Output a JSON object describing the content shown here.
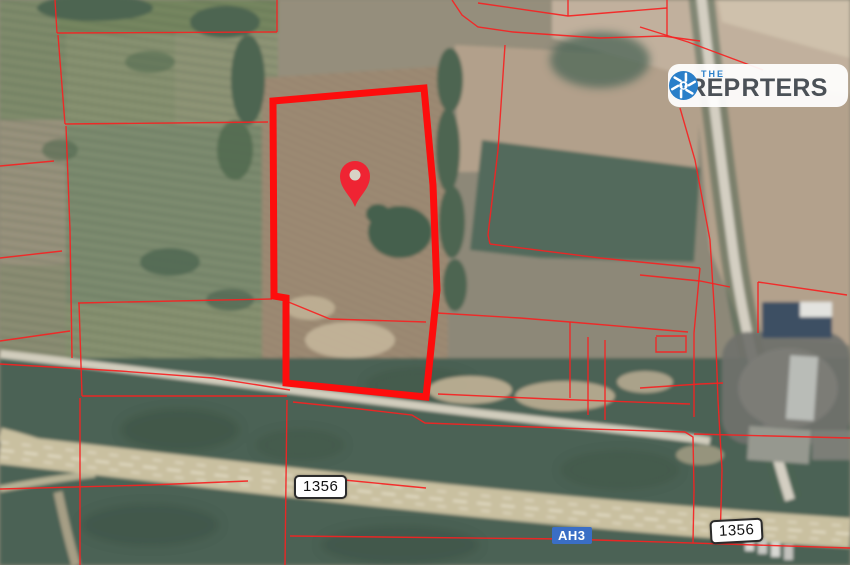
{
  "watermark": {
    "prefix": "THE",
    "brand_left": "REP",
    "brand_right": "RTERS",
    "accent_blue": "#2a7fc9",
    "text_color": "#4b5157"
  },
  "road_labels": {
    "route_left": "1356",
    "route_right": "1356",
    "highway": "AH3",
    "highway_bg": "#3a6ec5"
  },
  "overlay": {
    "line_color": "#f62222",
    "parcel_color": "#fd0d0d",
    "pin_color": "#ef2433",
    "pin_hole_color": "#d8d2c6",
    "parcel_polygon": "273,101 424,88 433,185 437,290 426,397 286,383 286,298 274,296",
    "pin": {
      "x": 355,
      "y": 176
    },
    "cadastral_lines": [
      "55,0 57,33",
      "57,33 277,32",
      "277,0 277,32",
      "58,35 65,124",
      "65,124 268,122",
      "66,126 70,230 72,358",
      "0,166 54,161",
      "0,258 62,251",
      "0,341 70,331",
      "78,303 272,299",
      "79,303 82,396",
      "82,396 287,396",
      "0,489 150,485 248,481",
      "287,400 286,480 285,565",
      "80,398 80,565",
      "0,364 120,371 213,378 290,390",
      "293,402 360,409 412,415 425,423 560,428 685,432",
      "685,432 693,437 694,490 693,543",
      "694,434 850,438",
      "290,536 565,539 850,548",
      "344,480 426,488",
      "437,313 520,318 570,322 688,332",
      "570,322 570,398",
      "588,337 588,415",
      "605,340 605,420",
      "656,336 686,336 686,352 656,352 656,337",
      "700,268 694,333 694,417",
      "490,244 600,258 700,268",
      "505,45 498,150 488,235 490,244",
      "452,0 462,15 478,27 513,32",
      "513,32 600,38 663,36 700,41",
      "478,3 568,16 667,8",
      "568,0 568,16",
      "667,0 667,36",
      "640,27 688,42 763,70",
      "680,108 695,160 710,240 715,320 718,400 722,470 720,543",
      "640,275 700,281 730,287",
      "758,282 847,295",
      "758,282 758,333",
      "640,388 700,384 723,383",
      "438,394 550,399 690,404",
      "286,301 330,319 426,322"
    ]
  }
}
